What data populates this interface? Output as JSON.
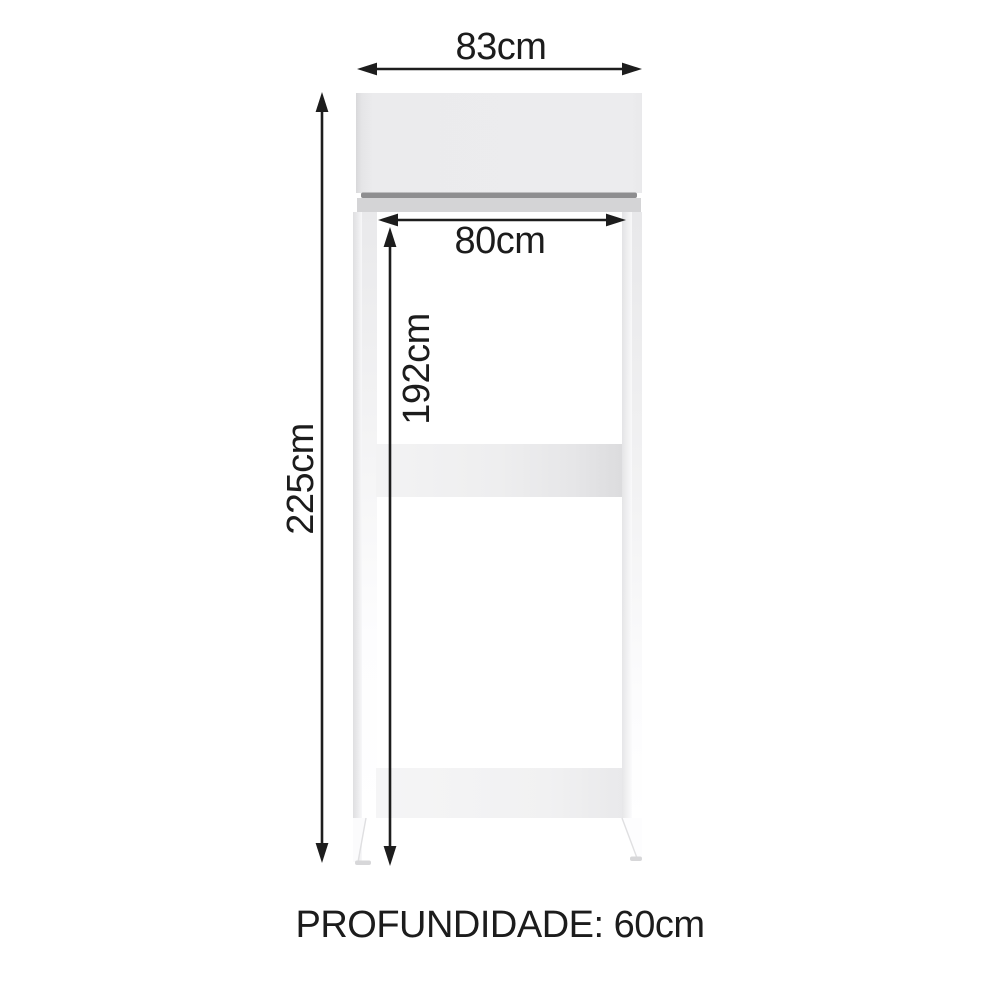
{
  "diagram": {
    "kind": "furniture-dimension-diagram",
    "depth_note": "PROFUNDIDADE: 60cm",
    "dimensions": {
      "outer_width": "83cm",
      "inner_width": "80cm",
      "total_height": "225cm",
      "inner_height": "192cm"
    },
    "colors": {
      "background": "#ffffff",
      "line": "#1d1d1d",
      "text": "#1c1c1c",
      "cabinet_light_gray": "#ebebed",
      "trim_dark_gray": "#8e8e90",
      "trim_mid_gray": "#d4d4d6",
      "shelf_gray": "#ececee",
      "edge_gray": "#e1e1e3"
    }
  }
}
